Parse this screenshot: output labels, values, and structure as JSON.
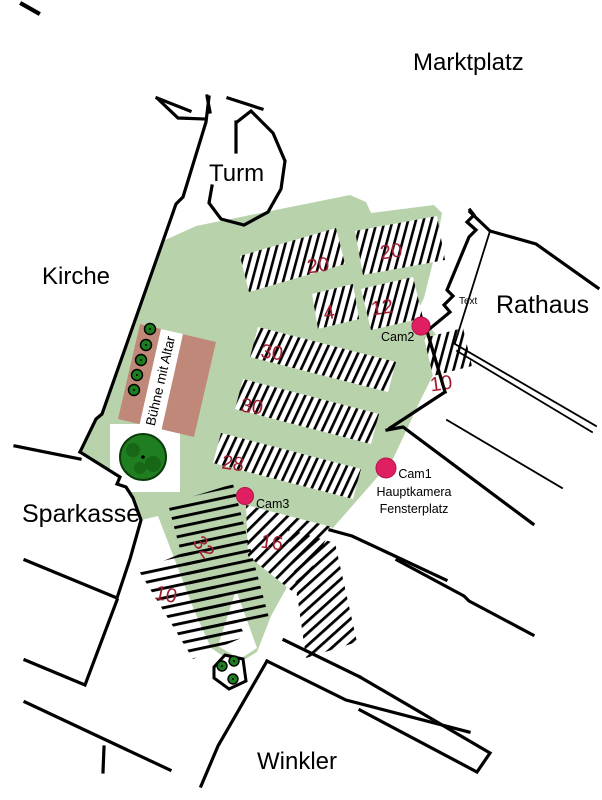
{
  "labels": {
    "marktplatz": "Marktplatz",
    "turm": "Turm",
    "kirche": "Kirche",
    "rathaus": "Rathaus",
    "rathaus_small_note": "Text",
    "sparkasse": "Sparkasse",
    "winkler": "Winkler"
  },
  "stage": {
    "label": "Bühne mit Altar"
  },
  "cameras": [
    {
      "id": "cam1",
      "label": "Cam1",
      "description_lines": [
        "Hauptkamera",
        "Fensterplatz"
      ],
      "dot_color": "#e01f63"
    },
    {
      "id": "cam2",
      "label": "Cam2",
      "dot_color": "#e01f63"
    },
    {
      "id": "cam3",
      "label": "Cam3",
      "dot_color": "#e01f63"
    }
  ],
  "seating_blocks": [
    {
      "id": "block-20-left",
      "count": "20"
    },
    {
      "id": "block-20-right",
      "count": "20"
    },
    {
      "id": "block-4",
      "count": "4"
    },
    {
      "id": "block-12",
      "count": "12"
    },
    {
      "id": "block-10-rathaus",
      "count": "10"
    },
    {
      "id": "block-30-upper",
      "count": "30"
    },
    {
      "id": "block-30-lower",
      "count": "30"
    },
    {
      "id": "block-28",
      "count": "28"
    },
    {
      "id": "block-16",
      "count": "16"
    },
    {
      "id": "block-32",
      "count": "32"
    },
    {
      "id": "block-10-left",
      "count": "10"
    }
  ],
  "colors": {
    "plaza_green": "#b8d2ab",
    "stage_fill": "#c08878",
    "seat_number_red": "#9f1d30",
    "camera_dot_pink": "#e01f63",
    "tree_green": "#1f7e1f",
    "outline_black": "#000000",
    "background": "#ffffff"
  }
}
